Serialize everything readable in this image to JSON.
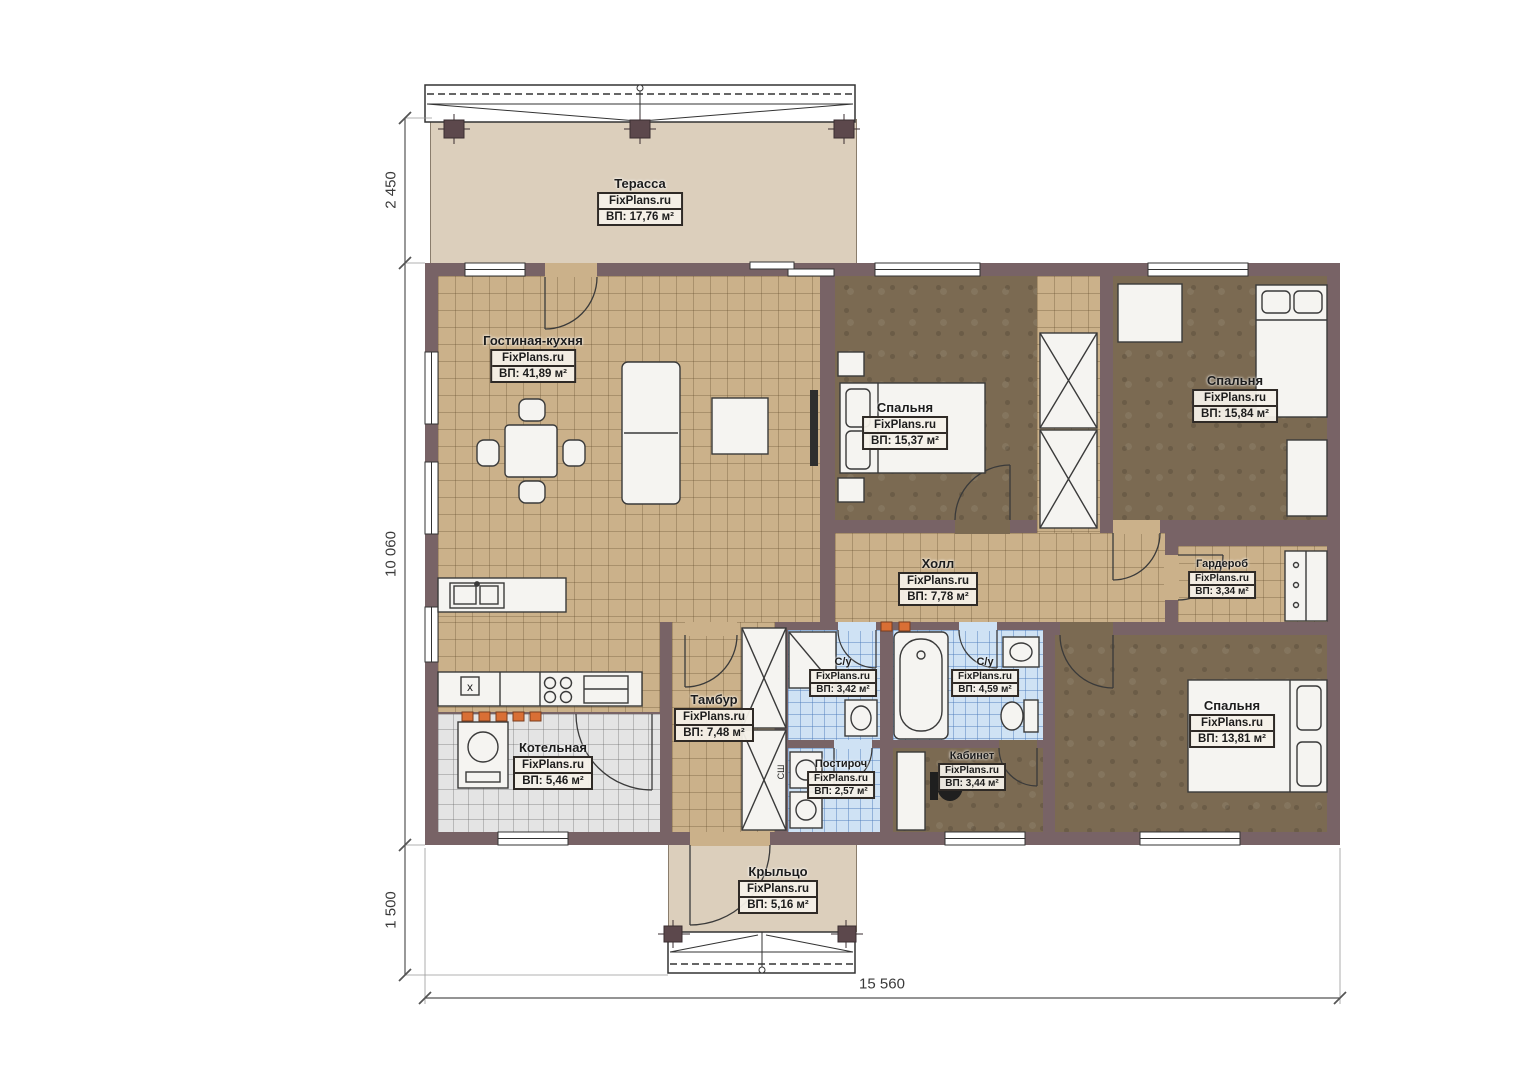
{
  "title": "План одноэтажного дома",
  "brand": "FixPlans.ru",
  "colors": {
    "wall": "#786366",
    "tan": "#cbb18a",
    "brown": "#7b6a52",
    "blue": "#cfe2f4",
    "gray": "#e4e4e4",
    "beige": "#dccfbc",
    "accent": "#d96f35",
    "ink": "#2f2a26"
  },
  "rooms": {
    "terrace": {
      "name": "Терасса",
      "brand": "FixPlans.ru",
      "area": "ВП: 17,76 м²"
    },
    "living_kitchen": {
      "name": "Гостиная-кухня",
      "brand": "FixPlans.ru",
      "area": "ВП: 41,89 м²"
    },
    "bedroom_1": {
      "name": "Спальня",
      "brand": "FixPlans.ru",
      "area": "ВП: 15,37 м²"
    },
    "bedroom_2": {
      "name": "Спальня",
      "brand": "FixPlans.ru",
      "area": "ВП: 15,84 м²"
    },
    "hall": {
      "name": "Холл",
      "brand": "FixPlans.ru",
      "area": "ВП: 7,78 м²"
    },
    "wardrobe": {
      "name": "Гардероб",
      "brand": "FixPlans.ru",
      "area": "ВП: 3,34 м²"
    },
    "vestibule": {
      "name": "Тамбур",
      "brand": "FixPlans.ru",
      "area": "ВП: 7,48 м²"
    },
    "bathroom_1": {
      "name": "С/у",
      "brand": "FixPlans.ru",
      "area": "ВП: 3,42 м²"
    },
    "bathroom_2": {
      "name": "С/у",
      "brand": "FixPlans.ru",
      "area": "ВП: 4,59 м²"
    },
    "laundry": {
      "name": "Постироч",
      "brand": "FixPlans.ru",
      "area": "ВП: 2,57 м²"
    },
    "office": {
      "name": "Кабинет",
      "brand": "FixPlans.ru",
      "area": "ВП: 3,44 м²"
    },
    "boiler": {
      "name": "Котельная",
      "brand": "FixPlans.ru",
      "area": "ВП: 5,46 м²"
    },
    "bedroom_3": {
      "name": "Спальня",
      "brand": "FixPlans.ru",
      "area": "ВП: 13,81 м²"
    },
    "porch": {
      "name": "Крыльцо",
      "brand": "FixPlans.ru",
      "area": "ВП: 5,16 м²"
    }
  },
  "dimensions": {
    "terrace_depth": "2 450",
    "house_depth": "10 060",
    "porch_depth": "1 500",
    "house_width": "15 560"
  },
  "annotations": {
    "kitchen_x": "x",
    "closet_label": "СШ"
  }
}
